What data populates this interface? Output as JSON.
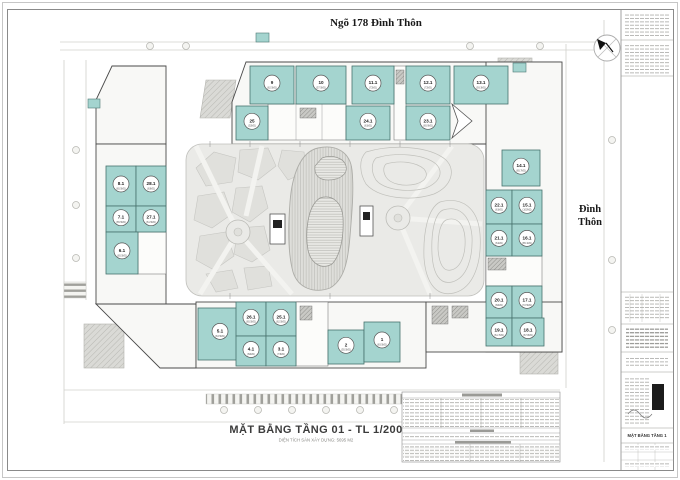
{
  "page": {
    "top_street_label": "Ngõ 178 Đình Thôn",
    "right_street_line1": "Đình",
    "right_street_line2": "Thôn"
  },
  "title": {
    "main": "MẶT BẰNG TẦNG 01 - TL 1/200",
    "subtitle": "DIỆN TÍCH SÀN XÂY DỰNG: 5695 M2"
  },
  "titleblock": {
    "drawing_name": "MẶT BẰNG TẦNG 1"
  },
  "colors": {
    "unit_fill": "#a4d4cf",
    "unit_border": "#47726d",
    "wall": "#4a4a4a",
    "courtyard": "#eaeae7",
    "paving": "#e0e0dc"
  },
  "units": [
    {
      "no": "9",
      "area": "62.5M2",
      "x": 250,
      "y": 66,
      "w": 44,
      "h": 38
    },
    {
      "no": "10",
      "area": "57.5M2",
      "x": 296,
      "y": 66,
      "w": 50,
      "h": 38
    },
    {
      "no": "11.1",
      "area": "72M2",
      "x": 352,
      "y": 66,
      "w": 42,
      "h": 38
    },
    {
      "no": "12.1",
      "area": "72M2",
      "x": 406,
      "y": 66,
      "w": 44,
      "h": 38
    },
    {
      "no": "13.1",
      "area": "93.3M2",
      "x": 454,
      "y": 66,
      "w": 54,
      "h": 38
    },
    {
      "no": "25",
      "area": "52M2",
      "x": 236,
      "y": 106,
      "w": 32,
      "h": 34
    },
    {
      "no": "24.1",
      "area": "61M2",
      "x": 346,
      "y": 106,
      "w": 44,
      "h": 34
    },
    {
      "no": "23.1",
      "area": "65.9M2",
      "x": 406,
      "y": 106,
      "w": 44,
      "h": 34
    },
    {
      "no": "8.1",
      "area": "65.5M2",
      "x": 106,
      "y": 166,
      "w": 30,
      "h": 40
    },
    {
      "no": "28.1",
      "area": "63M2",
      "x": 136,
      "y": 166,
      "w": 30,
      "h": 40
    },
    {
      "no": "7.1",
      "area": "65.5M2",
      "x": 106,
      "y": 206,
      "w": 30,
      "h": 26
    },
    {
      "no": "27.1",
      "area": "61.5M2",
      "x": 136,
      "y": 206,
      "w": 30,
      "h": 26
    },
    {
      "no": "6.1",
      "area": "65.5M2",
      "x": 106,
      "y": 232,
      "w": 32,
      "h": 42
    },
    {
      "no": "14.1",
      "area": "65.7M2",
      "x": 502,
      "y": 150,
      "w": 38,
      "h": 36
    },
    {
      "no": "22.1",
      "area": "61M2",
      "x": 486,
      "y": 190,
      "w": 26,
      "h": 34
    },
    {
      "no": "15.1",
      "area": "103M2",
      "x": 512,
      "y": 190,
      "w": 30,
      "h": 34
    },
    {
      "no": "21.1",
      "area": "61M2",
      "x": 486,
      "y": 224,
      "w": 26,
      "h": 32
    },
    {
      "no": "16.1",
      "area": "85.1M2",
      "x": 512,
      "y": 224,
      "w": 30,
      "h": 32
    },
    {
      "no": "20.1",
      "area": "60M2",
      "x": 486,
      "y": 286,
      "w": 26,
      "h": 32
    },
    {
      "no": "17.1",
      "area": "72.5M2",
      "x": 512,
      "y": 286,
      "w": 30,
      "h": 32
    },
    {
      "no": "19.1",
      "area": "61.7M2",
      "x": 486,
      "y": 318,
      "w": 26,
      "h": 28
    },
    {
      "no": "18.1",
      "area": "67.8M2",
      "x": 512,
      "y": 318,
      "w": 32,
      "h": 28
    },
    {
      "no": "5.1",
      "area": "63.5M2",
      "x": 198,
      "y": 308,
      "w": 44,
      "h": 52
    },
    {
      "no": "26.1",
      "area": "65.5M2",
      "x": 236,
      "y": 302,
      "w": 30,
      "h": 34
    },
    {
      "no": "25.1",
      "area": "62.5M2",
      "x": 266,
      "y": 302,
      "w": 30,
      "h": 34
    },
    {
      "no": "4.1",
      "area": "60M2",
      "x": 236,
      "y": 336,
      "w": 30,
      "h": 30
    },
    {
      "no": "3.1",
      "area": "73M2",
      "x": 266,
      "y": 336,
      "w": 30,
      "h": 30
    },
    {
      "no": "2",
      "area": "55.5M2",
      "x": 328,
      "y": 330,
      "w": 36,
      "h": 34
    },
    {
      "no": "1",
      "area": "83.5M2",
      "x": 364,
      "y": 322,
      "w": 36,
      "h": 40
    }
  ]
}
